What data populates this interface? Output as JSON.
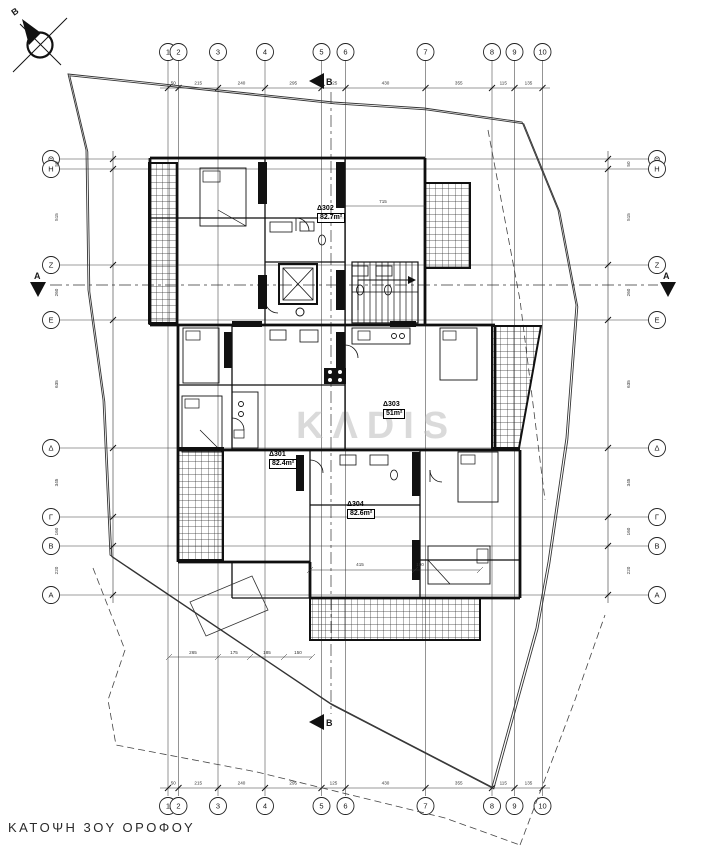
{
  "title": "ΚΑΤΟΨΗ 3ΟΥ ΟΡΟΦΟΥ",
  "north_label": "B",
  "watermark": "KΛDIS",
  "grid": {
    "columns": [
      {
        "label": "1",
        "x": 168
      },
      {
        "label": "2",
        "x": 178.5
      },
      {
        "label": "3",
        "x": 218
      },
      {
        "label": "4",
        "x": 265
      },
      {
        "label": "5",
        "x": 321.5
      },
      {
        "label": "6",
        "x": 345.5
      },
      {
        "label": "7",
        "x": 425.5
      },
      {
        "label": "8",
        "x": 492
      },
      {
        "label": "9",
        "x": 514.5
      },
      {
        "label": "10",
        "x": 542.5
      }
    ],
    "column_dims": [
      "50",
      "215",
      "240",
      "295",
      "125",
      "430",
      "355",
      "115",
      "135"
    ],
    "rows": [
      {
        "label": "Θ",
        "y": 159
      },
      {
        "label": "Η",
        "y": 169
      },
      {
        "label": "Ζ",
        "y": 265
      },
      {
        "label": "Ε",
        "y": 320
      },
      {
        "label": "Δ",
        "y": 448
      },
      {
        "label": "Γ",
        "y": 517
      },
      {
        "label": "Β",
        "y": 546
      },
      {
        "label": "Α",
        "y": 595
      }
    ],
    "row_dims": [
      "50",
      "515",
      "260",
      "635",
      "345",
      "160",
      "220"
    ]
  },
  "section_markers": {
    "horizontal": "A",
    "vertical": "B"
  },
  "apartments": [
    {
      "id": "Δ302",
      "area": "82.7m²"
    },
    {
      "id": "Δ303",
      "area": "51m²"
    },
    {
      "id": "Δ301",
      "area": "82.4m²"
    },
    {
      "id": "Δ304",
      "area": "82.6m²"
    }
  ],
  "inner_dims": [
    {
      "text": "715",
      "x": 383,
      "y": 203
    },
    {
      "text": "415",
      "x": 360,
      "y": 566
    },
    {
      "text": "190",
      "x": 420,
      "y": 566
    },
    {
      "text": "265",
      "x": 193,
      "y": 654
    },
    {
      "text": "175",
      "x": 234,
      "y": 654
    },
    {
      "text": "185",
      "x": 267,
      "y": 654
    },
    {
      "text": "150",
      "x": 298,
      "y": 654
    }
  ]
}
